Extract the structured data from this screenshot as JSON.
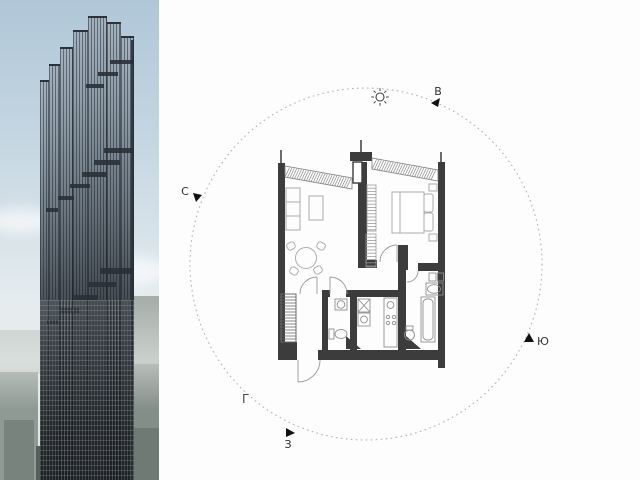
{
  "image": {
    "left_panel": "residential tower photo",
    "right_panel": "apartment floor plan with orientation compass"
  },
  "compass": {
    "north_label": "С",
    "east_label": "В",
    "south_label": "Ю",
    "west_label": "З",
    "corner_mark": "Г",
    "sun_icon": "sun"
  },
  "colors": {
    "wall": "#3c3c3c",
    "hatch_line": "#8a8a8a",
    "furniture_line": "#ababab",
    "dashed_circle": "#b3b3b3",
    "label_text": "#2f2f2f",
    "sky": "#bfd2de",
    "facade_light": "#a3b2be",
    "facade_dark": "#23272c",
    "city": "#93a09a"
  }
}
